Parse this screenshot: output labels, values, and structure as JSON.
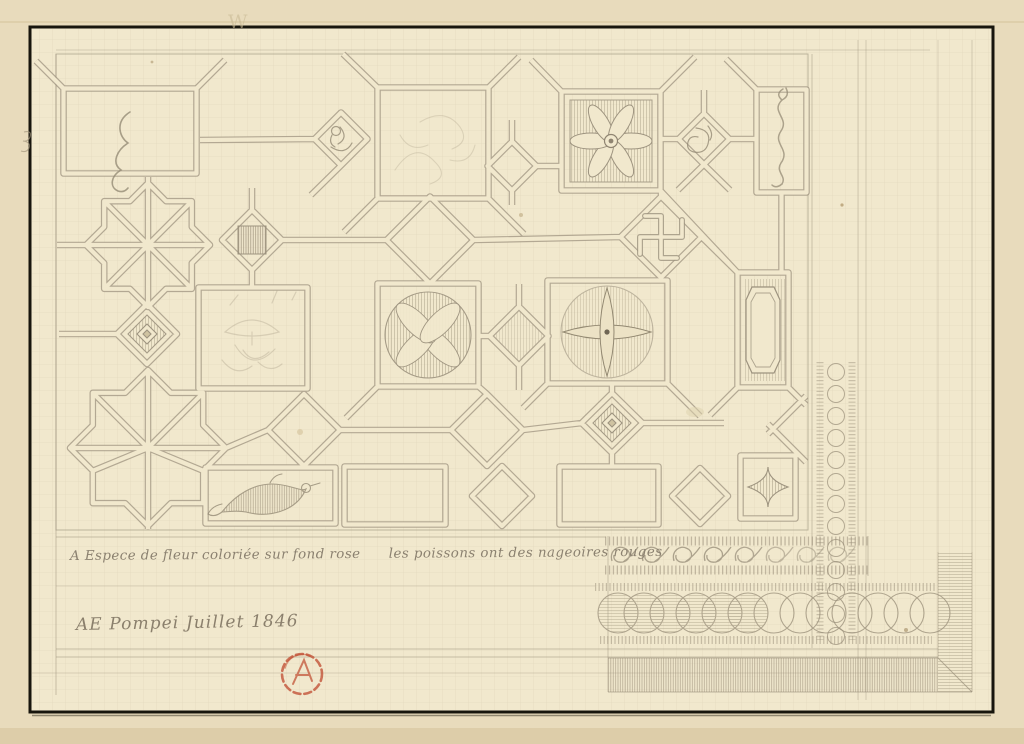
{
  "artwork": {
    "description": "Pencil drawing of a Pompeii mosaic ceiling/floor pattern on aged squared paper",
    "caption": "A Espece de fleur coloriée sur fond rose      les poissons ont des nageoires rouges",
    "signature": "AE Pompei Juillet 1846",
    "watermark": "W",
    "motifs": [
      "eight-pointed-star-lattice",
      "large-square-panels",
      "acanthus-scroll",
      "six-petal-rosette",
      "swastika-meander",
      "striped-square",
      "bird-in-diamond",
      "leaf-spiral-in-diamond",
      "dolphin-panel",
      "vase-with-plants",
      "quatrefoil-in-circle",
      "cross-in-circle",
      "octagon-panel",
      "concentric-diamonds",
      "fish-panel",
      "concave-square",
      "wave-scroll-border",
      "bead-tick-rows",
      "guilloche-circle-chain",
      "hatched-corner-band"
    ]
  },
  "colors": {
    "mount": "#e8dbbc",
    "paper": "#f1e8cd",
    "pencil": "#9d937f",
    "grid": "#b3a583",
    "frame": "#17150d",
    "stamp_red": "#bf4a2e"
  }
}
